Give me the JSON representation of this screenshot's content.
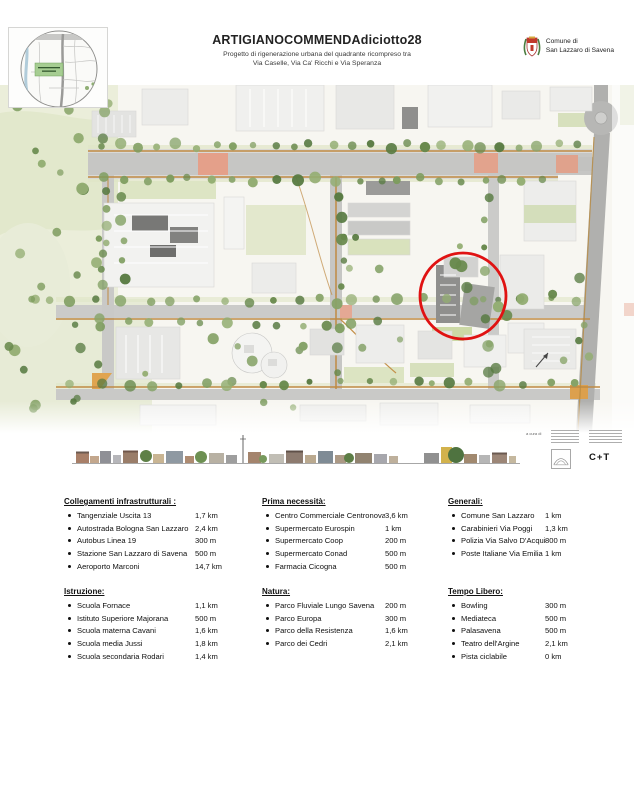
{
  "header": {
    "title": "ARTIGIANOCOMMENDAdiciotto28",
    "subtitle_line1": "Progetto di rigenerazione urbana del quadrante ricompreso tra",
    "subtitle_line2": "Via Caselle, Via Ca' Ricchi e Via Speranza"
  },
  "municipality": {
    "line1": "Comune di",
    "line2": "San Lazzaro di Savena"
  },
  "credits": {
    "curated_by": "a cura di",
    "studio_logo": "C+T"
  },
  "colors": {
    "highlight_red": "#e01212",
    "path_orange": "#bf8a43",
    "plaza_salmon": "#e2a38d",
    "park_green": "#e7ebd6",
    "tree_green": "#6f9150",
    "road_gray": "#c6c6c4"
  },
  "sections": [
    {
      "id": "collegamenti",
      "title": "Collegamenti infrastrutturali :",
      "items": [
        {
          "label": "Tangenziale Uscita 13",
          "value": "1,7 km"
        },
        {
          "label": "Autostrada Bologna San Lazzaro",
          "value": "2,4 km"
        },
        {
          "label": "Autobus Linea 19",
          "value": "300 m"
        },
        {
          "label": "Stazione San Lazzaro di Savena",
          "value": "500 m"
        },
        {
          "label": "Aeroporto Marconi",
          "value": "14,7 km"
        }
      ]
    },
    {
      "id": "prima-necessita",
      "title": "Prima necessità:",
      "items": [
        {
          "label": "Centro Commerciale Centronova",
          "value": "3,6 km"
        },
        {
          "label": "Supermercato Eurospin",
          "value": "1 km"
        },
        {
          "label": "Supermercato Coop",
          "value": "200 m"
        },
        {
          "label": "Supermercato Conad",
          "value": "500 m"
        },
        {
          "label": "Farmacia Cicogna",
          "value": "500 m"
        }
      ]
    },
    {
      "id": "generali",
      "title": "Generali:",
      "items": [
        {
          "label": "Comune San Lazzaro",
          "value": "1 km"
        },
        {
          "label": "Carabinieri Via Poggi",
          "value": "1,3 km"
        },
        {
          "label": "Polizia Via Salvo D'Acquisto",
          "value": "800 m"
        },
        {
          "label": "Poste Italiane Via Emilia",
          "value": "1 km"
        }
      ]
    },
    {
      "id": "istruzione",
      "title": "Istruzione:",
      "items": [
        {
          "label": "Scuola Fornace",
          "value": "1,1 km"
        },
        {
          "label": "Istituto Superiore Majorana",
          "value": "500 m"
        },
        {
          "label": "Scuola materna Cavani",
          "value": "1,6 km"
        },
        {
          "label": "Scuola media Jussi",
          "value": "1,8 km"
        },
        {
          "label": "Scuola secondaria Rodari",
          "value": "1,4 km"
        }
      ]
    },
    {
      "id": "natura",
      "title": "Natura:",
      "items": [
        {
          "label": "Parco Fluviale Lungo Savena",
          "value": "200 m"
        },
        {
          "label": "Parco Europa",
          "value": "300 m"
        },
        {
          "label": "Parco della Resistenza",
          "value": "1,6 km"
        },
        {
          "label": "Parco dei Cedri",
          "value": "2,1 km"
        }
      ]
    },
    {
      "id": "tempo-libero",
      "title": "Tempo Libero:",
      "items": [
        {
          "label": "Bowling",
          "value": "300 m"
        },
        {
          "label": "Mediateca",
          "value": "500 m"
        },
        {
          "label": "Palasavena",
          "value": "500 m"
        },
        {
          "label": "Teatro dell'Argine",
          "value": "2,1 km"
        },
        {
          "label": "Pista ciclabile",
          "value": "0 km"
        }
      ]
    }
  ]
}
